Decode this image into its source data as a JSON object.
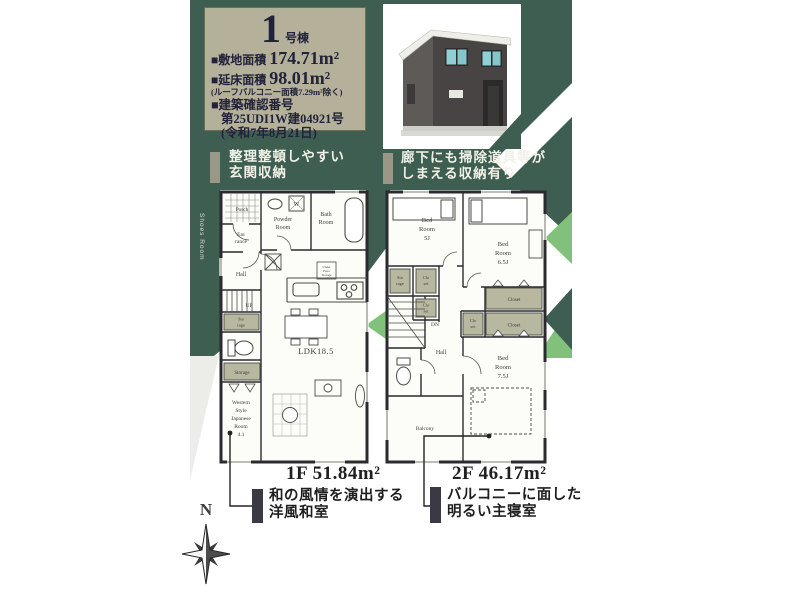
{
  "colors": {
    "dark_green": "#3f5e52",
    "light_green": "#82c17b",
    "info_box_beige": "#b4b099",
    "closet_olive": "#b7b89f",
    "wall": "#2b2b2f"
  },
  "info_box": {
    "unit_number": "1",
    "unit_suffix": "号棟",
    "site_area_label": "■敷地面積",
    "site_area_value": "174.71m²",
    "floor_area_label": "■延床面積",
    "floor_area_value": "98.01m²",
    "floor_area_note": "(ルーフバルコニー面積7.29m²除く)",
    "permit_label": "■建築確認番号",
    "permit_number": "第25UDI1W建04921号",
    "permit_date": "(令和7年8月21日)"
  },
  "callouts": {
    "top_left": {
      "line1": "整理整頓しやすい",
      "line2": "玄関収納"
    },
    "top_right": {
      "line1": "廊下にも掃除道具等が",
      "line2": "しまえる収納有り"
    },
    "bottom_left": {
      "line1": "和の風情を演出する",
      "line2": "洋風和室"
    },
    "bottom_right": {
      "line1": "バルコニーに面した",
      "line2": "明るい主寝室"
    }
  },
  "floor1": {
    "side_label": "Shoes Room",
    "title": "1F 51.84m²",
    "rooms": {
      "porch": "Porch",
      "entrance_l1": "Ent",
      "entrance_l2": "rance",
      "powder_l1": "Powder",
      "powder_l2": "Room",
      "bath_l1": "Bath",
      "bath_l2": "Room",
      "hall": "Hall",
      "up": "UP",
      "sto_l1": "Sto",
      "sto_l2": "rage",
      "storage": "Storage",
      "wsj_l1": "Western",
      "wsj_l2": "Style",
      "wsj_l3": "Japanese",
      "wsj_l4": "Room",
      "wsj_l5": "4.1",
      "ldk": "LDK18.5",
      "washer": "W",
      "underfloor_l1": "Under",
      "underfloor_l2": "Floor",
      "underfloor_l3": "Storage"
    }
  },
  "floor2": {
    "title": "2F 46.17m²",
    "rooms": {
      "bed5_l1": "Bed",
      "bed5_l2": "Room",
      "bed5_l3": "5J",
      "bed65_l1": "Bed",
      "bed65_l2": "Room",
      "bed65_l3": "6.5J",
      "bed75_l1": "Bed",
      "bed75_l2": "Room",
      "bed75_l3": "7.5J",
      "sto_l1": "Sto",
      "sto_l2": "rage",
      "clo1_l1": "Clo",
      "clo1_l2": "set",
      "clo2_l1": "Clo",
      "clo2_l2": "set",
      "clo3_l1": "Clo",
      "clo3_l2": "set",
      "closet_a": "Closet",
      "closet_b": "Closet",
      "dn": "DN",
      "hall": "Hall",
      "balcony": "Balcony"
    }
  },
  "compass": {
    "label": "N"
  }
}
